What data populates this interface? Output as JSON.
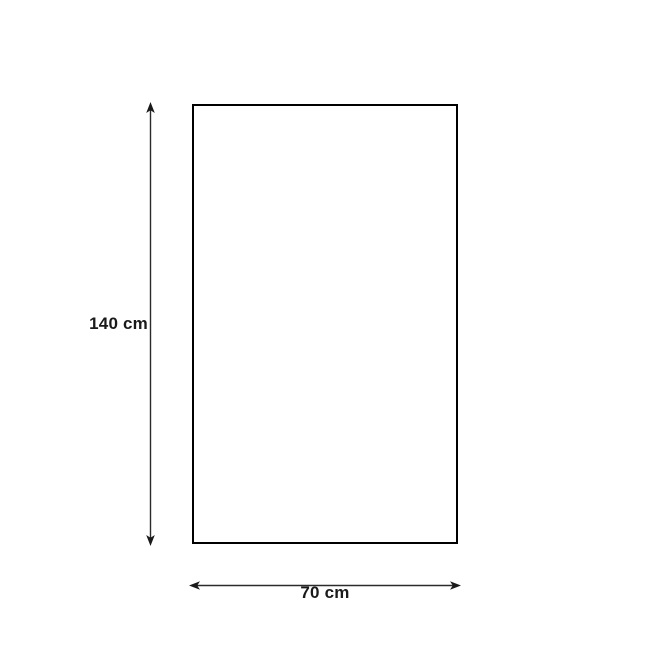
{
  "diagram": {
    "shape": "rectangle",
    "height_dimension": {
      "label": "140 cm",
      "value": 140,
      "unit": "cm"
    },
    "width_dimension": {
      "label": "70 cm",
      "value": 70,
      "unit": "cm"
    },
    "colors": {
      "background": "#ffffff",
      "rectangle_outline": "#000000",
      "arrow_line": "#2b2b2b",
      "arrow_head": "#1a1a1a",
      "label_text": "#1a1a1a"
    }
  }
}
